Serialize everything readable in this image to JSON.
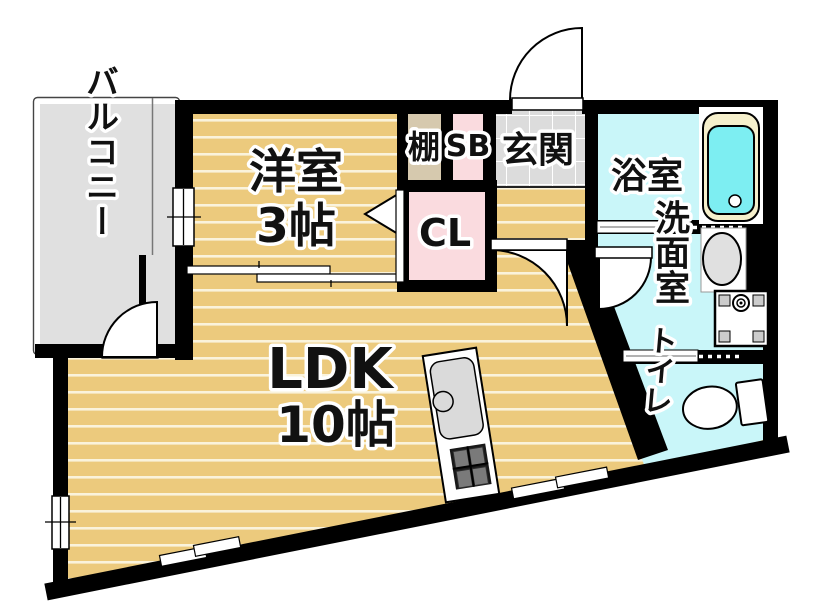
{
  "rooms": {
    "balcony": {
      "label": "バルコニー"
    },
    "western_room": {
      "label": "洋室",
      "size": "3帖"
    },
    "ldk": {
      "label": "LDK",
      "size": "10帖"
    },
    "shelf": {
      "label": "棚"
    },
    "shoe_box": {
      "label": "SB"
    },
    "entrance": {
      "label": "玄関"
    },
    "bathroom": {
      "label": "浴室"
    },
    "closet": {
      "label": "CL"
    },
    "washroom": {
      "label": "洗面室"
    },
    "toilet": {
      "label": "トイレ"
    }
  },
  "colors": {
    "wall": "#000000",
    "floor_wood": "#ecca7d",
    "floor_stripe": "#faf3dc",
    "balcony_gray": "#e0e0e0",
    "wet_room_cyan": "#c9f6f9",
    "closet_pink": "#fadbdf",
    "shelf_beige": "#d6c9ae",
    "entrance_tile": "#dcdcdc",
    "bathtub_cyan": "#7deef2",
    "bathtub_rim_cream": "#f6f0cc",
    "fixture_gray": "#e0e0e0"
  }
}
